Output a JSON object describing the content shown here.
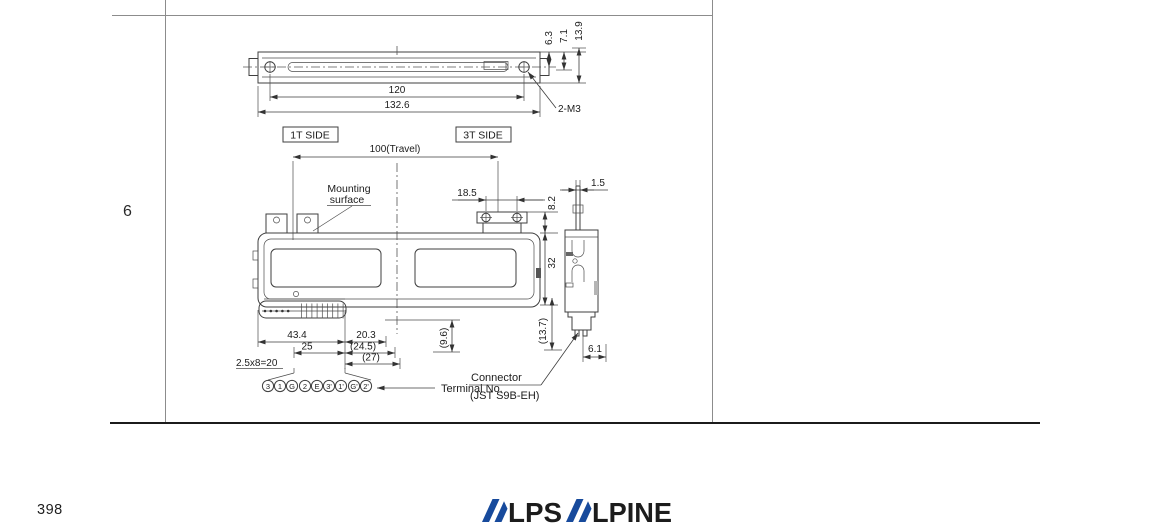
{
  "page": {
    "row_label": "6",
    "page_number": "398"
  },
  "logo": {
    "text": "ALPSALPINE",
    "lps": "LPS",
    "lpine": "LPINE",
    "color": "#174a9c"
  },
  "drawing": {
    "top_view": {
      "dim_travel_body": "120",
      "dim_overall": "132.6",
      "dim_6_3": "6.3",
      "dim_7_1": "7.1",
      "dim_13_9": "13.9",
      "screw_note": "2-M3"
    },
    "section_labels": {
      "side_1t": "1T SIDE",
      "side_3t": "3T SIDE",
      "travel": "100(Travel)",
      "mounting_line1": "Mounting",
      "mounting_line2": "surface"
    },
    "front_view": {
      "dim_18_5": "18.5",
      "dim_8_2": "8.2",
      "dim_32": "32",
      "dim_43_4": "43.4",
      "dim_25": "25",
      "dim_20_3": "20.3",
      "dim_24_5": "(24.5)",
      "dim_27": "(27)",
      "dim_pitch": "2.5x8=20",
      "dim_9_6": "(9.6)",
      "dim_13_7": "(13.7)"
    },
    "side_view": {
      "dim_1_5": "1.5",
      "dim_6_1": "6.1"
    },
    "connector": {
      "terminal_label": "Terminal No.",
      "name": "Connector",
      "type": "(JST S9B-EH)"
    },
    "terminals": [
      "3",
      "1",
      "G",
      "2",
      "E",
      "3'",
      "1'",
      "G'",
      "2'"
    ]
  }
}
